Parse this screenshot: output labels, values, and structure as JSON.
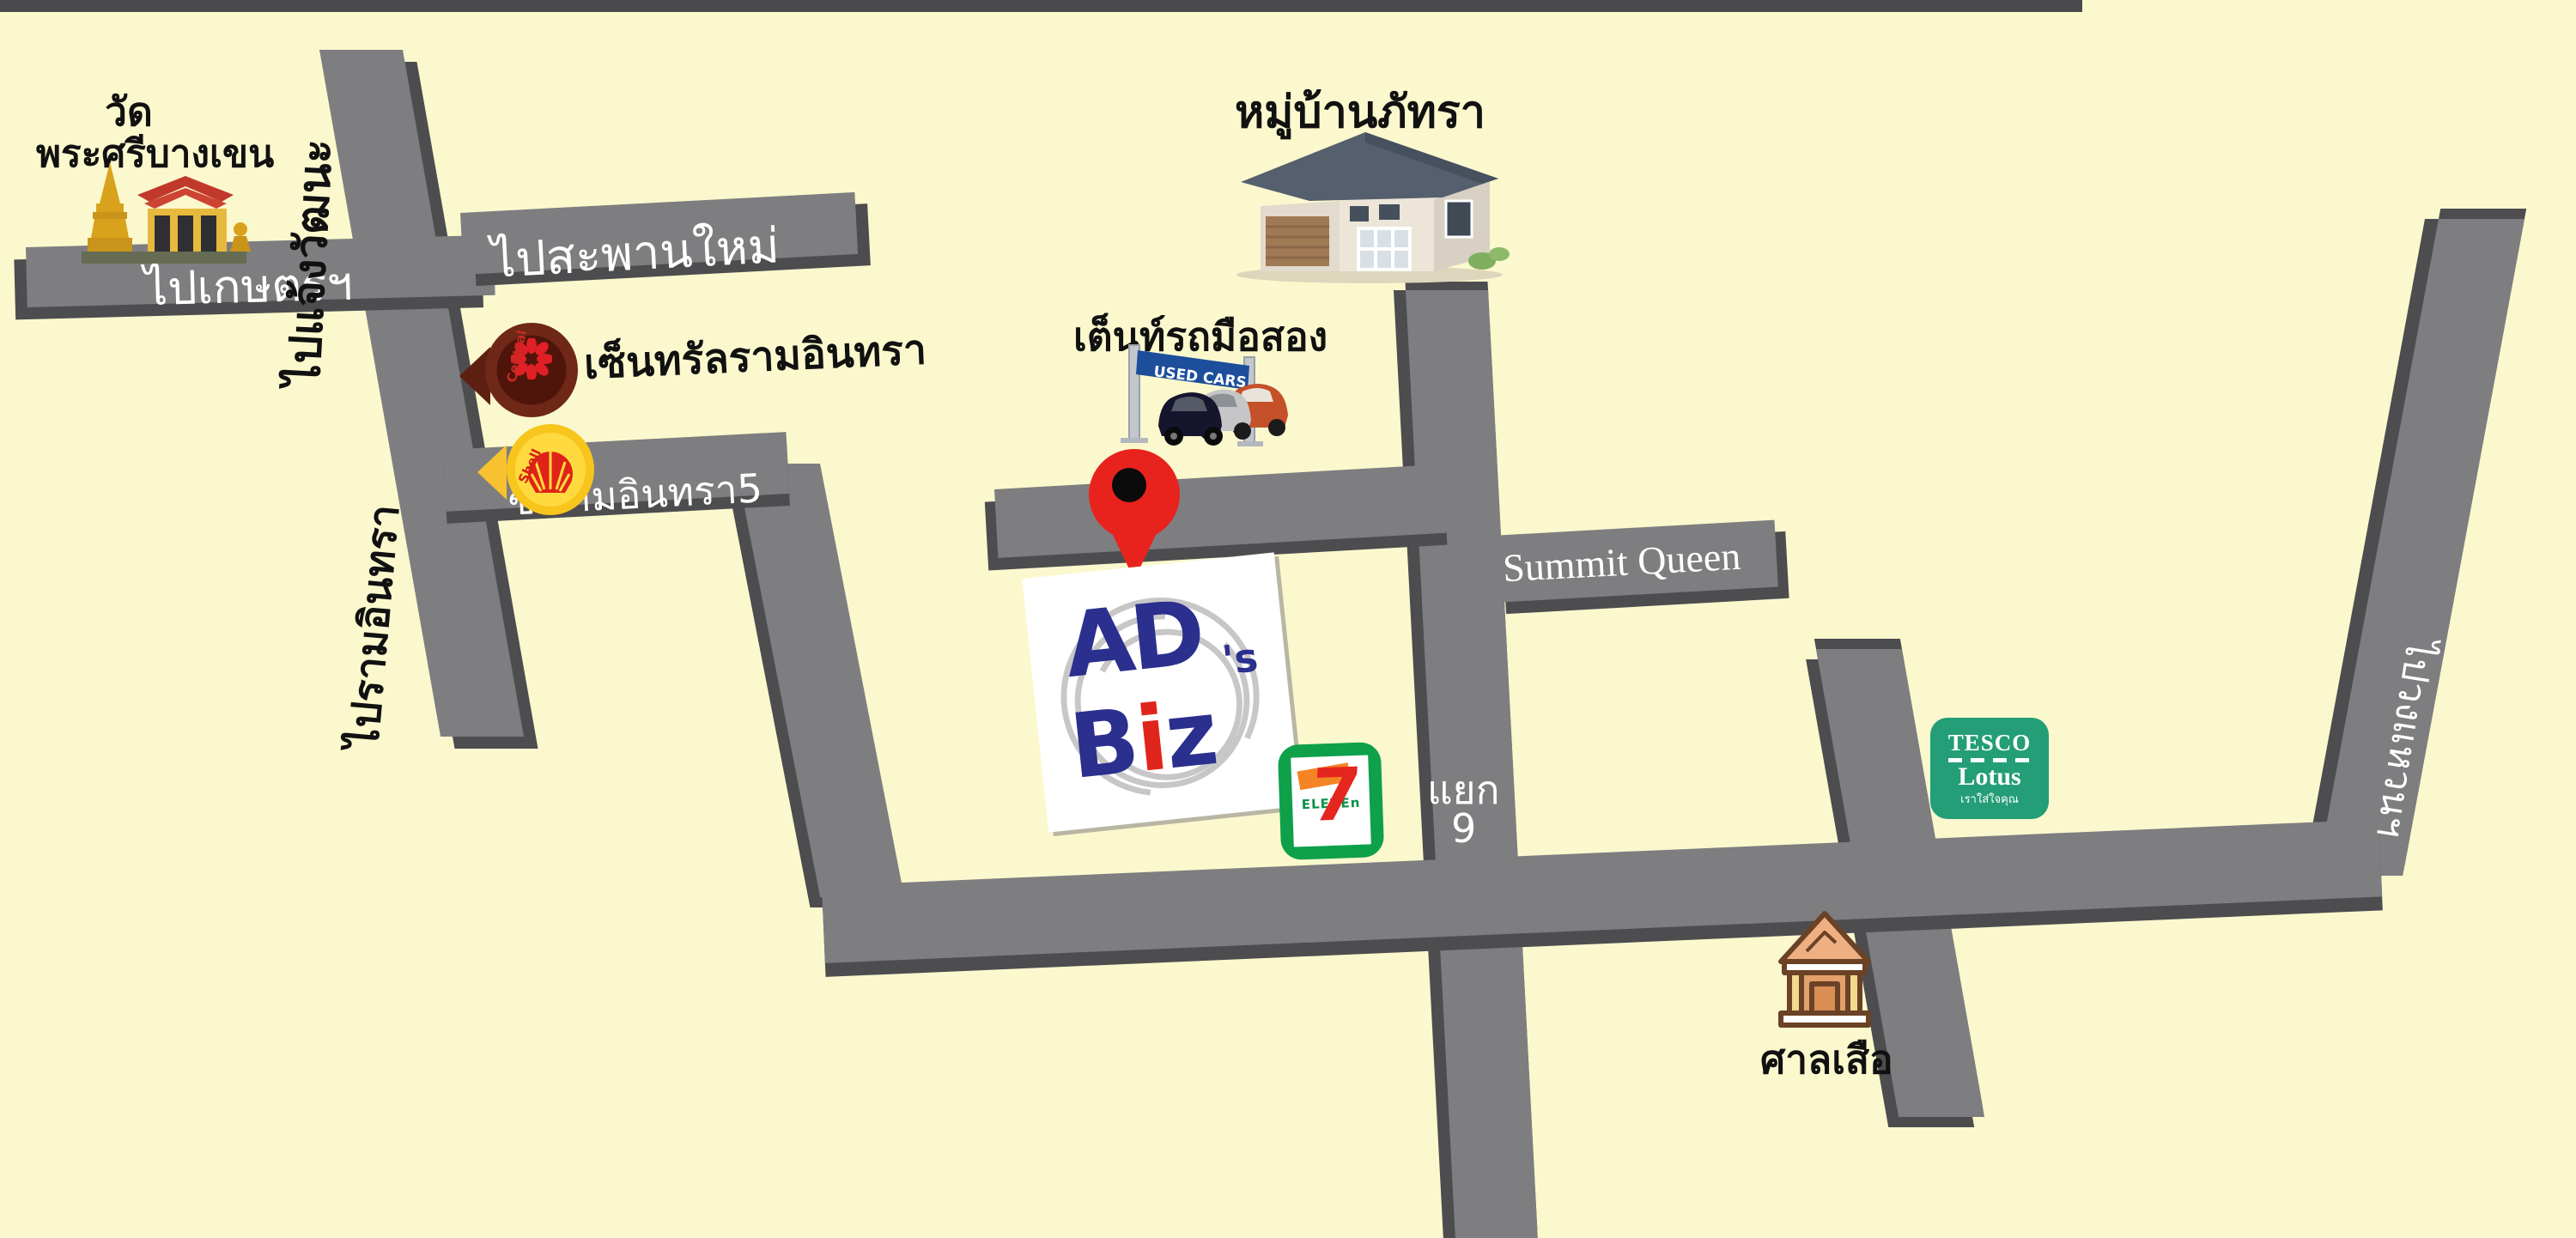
{
  "map": {
    "colors": {
      "background": "#FBF8CE",
      "road": "#7E7E80",
      "road_edge": "#4D4D4F",
      "pin_red": "#E8231D",
      "seven_green": "#0FA04A",
      "tesco_green": "#239E77",
      "shell_yellow": "#F8C51D",
      "central_maroon": "#6F2818",
      "banner_blue": "#1C4E9B"
    },
    "road_labels": {
      "to_kaset": "ไปเกษตรฯ",
      "to_saphan_mai": "ไปสะพานใหม่",
      "to_chaengwattana": "ไปแจ้งวัฒนะ",
      "to_ramindra": "ไปรามอินทรา",
      "soi_ramindra_5": "ซ.รามอินทรา5",
      "summit_queen": "Summit Queen",
      "junction_word": "แยก",
      "junction_number": "9",
      "to_ring_road": "ไปวงแหวนฯ"
    },
    "landmarks": {
      "temple_line1": "วัด",
      "temple_line2": "พระศรีบางเขน",
      "central_ramindra": "เซ็นทรัลรามอินทรา",
      "village": "หมู่บ้านภัทรา",
      "used_car_tent": "เต็นท์รถมือสอง",
      "used_cars_banner": "USED CARS",
      "tiger_shrine": "ศาลเสือ"
    },
    "logos": {
      "adsbiz": {
        "word1": "AD",
        "apostrophe_s": "'s",
        "word2_b": "B",
        "word2_i": "i",
        "word2_z": "z"
      },
      "central": {
        "text": "Central"
      },
      "shell": {
        "text": "Shell"
      },
      "seven_eleven": {
        "seven": "7",
        "eleven": "ELEVEn"
      },
      "tesco": {
        "line1": "TESCO",
        "line2": "Lotus",
        "tagline": "เราใส่ใจคุณ"
      }
    }
  }
}
